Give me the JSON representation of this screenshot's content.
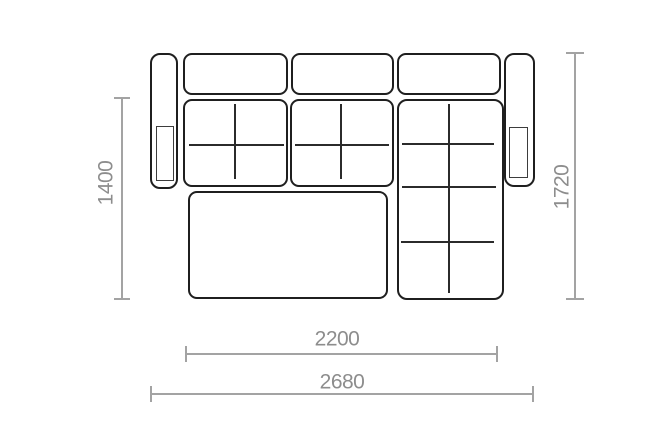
{
  "diagram": {
    "title": "sofa-top-view-dimension-drawing",
    "dimensions": {
      "left_depth": "1400",
      "right_depth": "1720",
      "inner_width": "2200",
      "outer_width": "2680"
    },
    "parts": {
      "left_armrest": "left armrest",
      "right_armrest": "right armrest",
      "back_cushions": 3,
      "seat_cushions": 2,
      "chaise": "chaise longue section",
      "ottoman": "pull-out ottoman seat"
    },
    "colors": {
      "outline": "#1f1f1f",
      "dimension_line": "#a3a3a3",
      "dimension_text": "#8d8d8d",
      "background": "#ffffff"
    }
  }
}
